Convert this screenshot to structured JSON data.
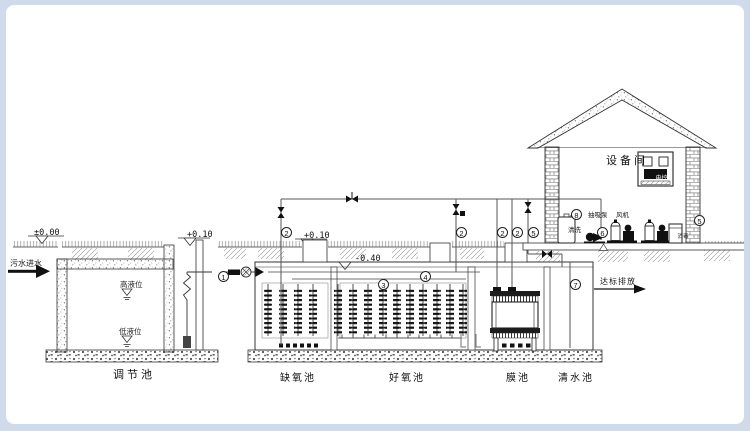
{
  "flow": {
    "influent": "污水进水",
    "effluent": "达标排放"
  },
  "levels": {
    "ground": "±0.00",
    "regulating_wall": "+0.10",
    "bio_wall": "+0.10",
    "water": "-0.40",
    "high": "高液位",
    "low": "低液位"
  },
  "tanks": {
    "regulating": "调节池",
    "anoxic": "缺氧池",
    "aerobic": "好氧池",
    "membrane": "膜池",
    "clearwater": "清水池"
  },
  "room": {
    "name": "设备间",
    "panel": "电控",
    "wash_tank": "清洗",
    "suction_pump": "抽吸泵",
    "blower": "风机",
    "dosing_cabinet": "消毒"
  },
  "callouts": {
    "n1": "1",
    "n2": "2",
    "n3": "3",
    "n4": "4",
    "n5": "5",
    "n6": "6",
    "n7": "7",
    "n8": "8"
  }
}
